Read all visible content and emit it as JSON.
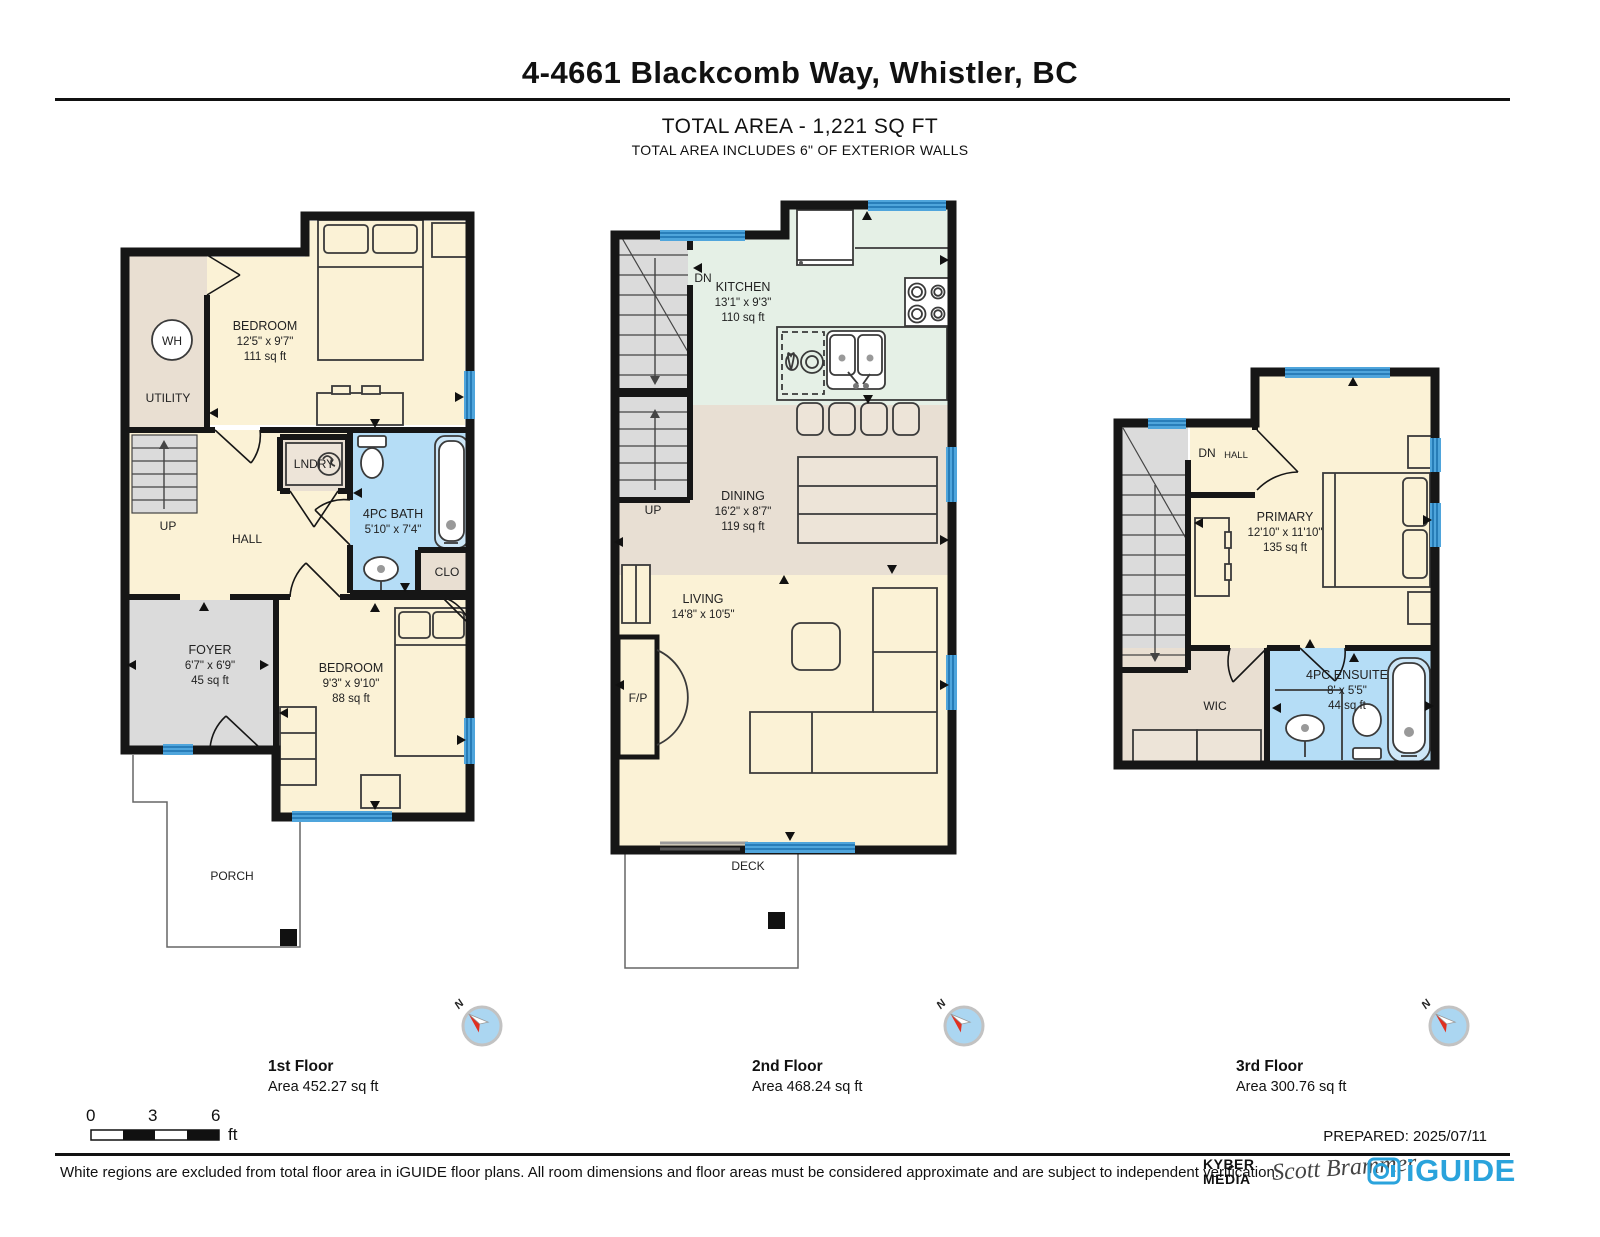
{
  "header": {
    "title": "4-4661 Blackcomb Way, Whistler, BC",
    "total_area": "TOTAL AREA - 1,221 SQ FT",
    "total_area_note": "TOTAL AREA INCLUDES 6\" OF EXTERIOR WALLS"
  },
  "floor1": {
    "caption": "1st Floor",
    "caption_area": "Area 452.27 sq ft",
    "wh": "WH",
    "utility": "UTILITY",
    "bedroom1_name": "BEDROOM",
    "bedroom1_dim": "12'5\" x 9'7\"",
    "bedroom1_area": "111 sq ft",
    "lndry": "LNDRY",
    "up": "UP",
    "hall": "HALL",
    "bath_name": "4PC BATH",
    "bath_dim": "5'10\" x 7'4\"",
    "clo": "CLO",
    "foyer_name": "FOYER",
    "foyer_dim": "6'7\" x 6'9\"",
    "foyer_area": "45 sq ft",
    "bedroom2_name": "BEDROOM",
    "bedroom2_dim": "9'3\" x 9'10\"",
    "bedroom2_area": "88 sq ft",
    "porch": "PORCH"
  },
  "floor2": {
    "caption": "2nd Floor",
    "caption_area": "Area 468.24 sq ft",
    "dn": "DN",
    "kitchen_name": "KITCHEN",
    "kitchen_dim": "13'1\" x 9'3\"",
    "kitchen_area": "110 sq ft",
    "up": "UP",
    "dining_name": "DINING",
    "dining_dim": "16'2\" x 8'7\"",
    "dining_area": "119 sq ft",
    "living_name": "LIVING",
    "living_dim": "14'8\" x 10'5\"",
    "fp": "F/P",
    "deck": "DECK"
  },
  "floor3": {
    "caption": "3rd Floor",
    "caption_area": "Area 300.76 sq ft",
    "dn": "DN",
    "hall": "HALL",
    "primary_name": "PRIMARY",
    "primary_dim": "12'10\" x 11'10\"",
    "primary_area": "135 sq ft",
    "wic": "WIC",
    "ensuite_name": "4PC ENSUITE",
    "ensuite_dim": "8' x 5'5\"",
    "ensuite_area": "44 sq ft"
  },
  "compass": {
    "north": "N"
  },
  "scale_bar": {
    "t0": "0",
    "t3": "3",
    "t6": "6",
    "unit": "ft"
  },
  "footer": {
    "prepared": "PREPARED: 2025/07/11",
    "disclaimer": "White regions are excluded from total floor area in iGUIDE floor plans. All room dimensions and floor areas must be considered approximate and are subject to independent verification.",
    "kyber_line1": "KYBER",
    "kyber_line2": "MEDIA",
    "signature": "Scott Brammer",
    "iguide": "iGUIDE"
  },
  "colors": {
    "wall": "#161616",
    "room_cream": "#FBF2D6",
    "room_tan": "#E9DFD2",
    "room_gray": "#DBDBDB",
    "bath_blue": "#B5DDF6",
    "kitchen_green": "#E5F0E6",
    "dining_tan": "#E8DFD3",
    "window_blue": "#4FA5DC",
    "iguide_blue": "#2AA3DC",
    "compass_red": "#E03020"
  }
}
